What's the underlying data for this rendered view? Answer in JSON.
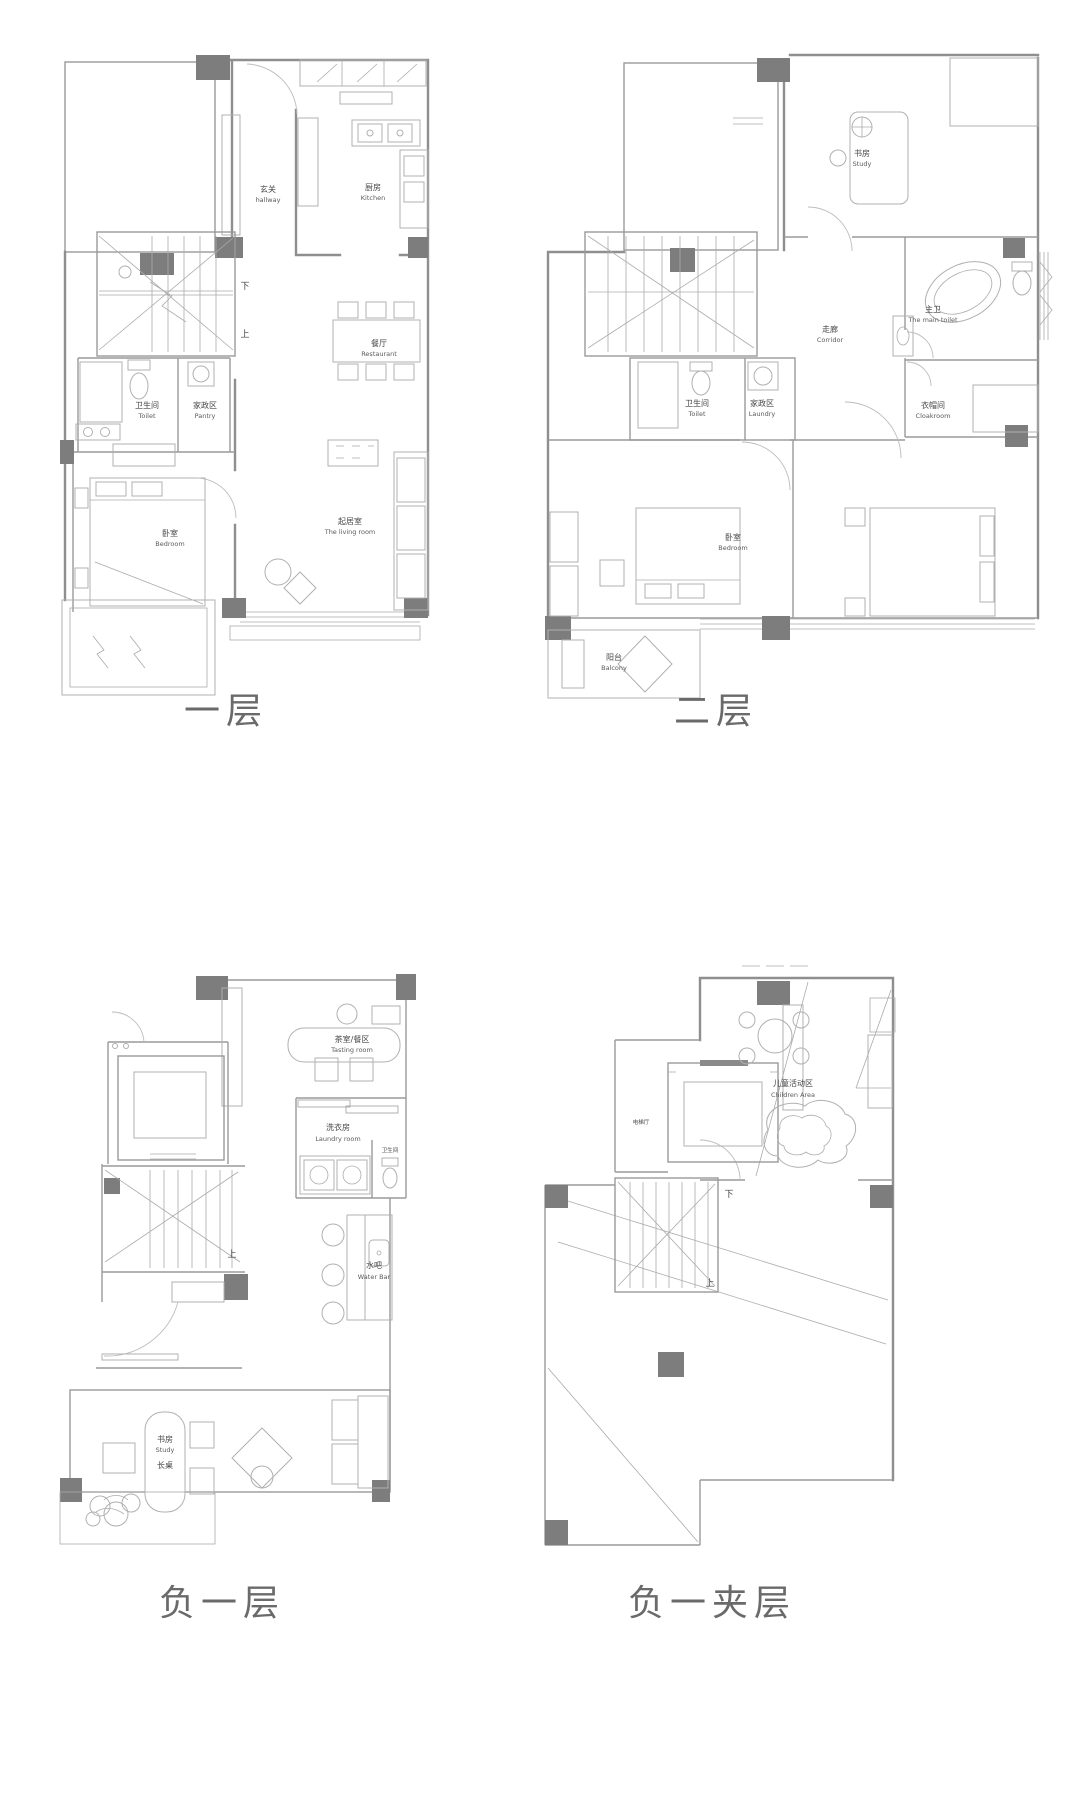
{
  "captions": {
    "floor1": "一层",
    "floor2": "二层",
    "basement": "负一层",
    "mezzanine": "负一夹层"
  },
  "floor1": {
    "rooms": {
      "hallway": {
        "zh": "玄关",
        "en": "hallway"
      },
      "kitchen": {
        "zh": "厨房",
        "en": "Kitchen"
      },
      "dining": {
        "zh": "餐厅",
        "en": "Restaurant"
      },
      "toilet": {
        "zh": "卫生间",
        "en": "Toilet"
      },
      "pantry": {
        "zh": "家政区",
        "en": "Pantry"
      },
      "bedroom": {
        "zh": "卧室",
        "en": "Bedroom"
      },
      "living": {
        "zh": "起居室",
        "en": "The living room"
      }
    },
    "stairs": {
      "up": "上",
      "down": "下"
    }
  },
  "floor2": {
    "rooms": {
      "study": {
        "zh": "书房",
        "en": "Study"
      },
      "corridor": {
        "zh": "走廊",
        "en": "Corridor"
      },
      "main_bath": {
        "zh": "主卫",
        "en": "The main toilet"
      },
      "cloakroom": {
        "zh": "衣帽间",
        "en": "Cloakroom"
      },
      "toilet": {
        "zh": "卫生间",
        "en": "Toilet"
      },
      "laundry": {
        "zh": "家政区",
        "en": "Laundry"
      },
      "bedroom": {
        "zh": "卧室",
        "en": "Bedroom"
      },
      "balcony": {
        "zh": "阳台",
        "en": "Balcony"
      }
    }
  },
  "basement": {
    "rooms": {
      "tasting": {
        "zh": "茶室/餐区",
        "en": "Tasting room"
      },
      "laundry": {
        "zh": "洗衣房",
        "en": "Laundry room"
      },
      "toilet": {
        "zh": "卫生间",
        "en": ""
      },
      "water_bar": {
        "zh": "水吧",
        "en": "Water Bar"
      },
      "study": {
        "zh": "书房",
        "en": "Study"
      },
      "table": {
        "zh": "长桌",
        "en": ""
      }
    },
    "stairs": {
      "up": "上"
    }
  },
  "mezzanine": {
    "rooms": {
      "elevator": {
        "zh": "电梯厅",
        "en": ""
      },
      "children": {
        "zh": "儿童活动区",
        "en": "Children Area"
      }
    },
    "stairs": {
      "up": "上",
      "down": "下"
    }
  }
}
